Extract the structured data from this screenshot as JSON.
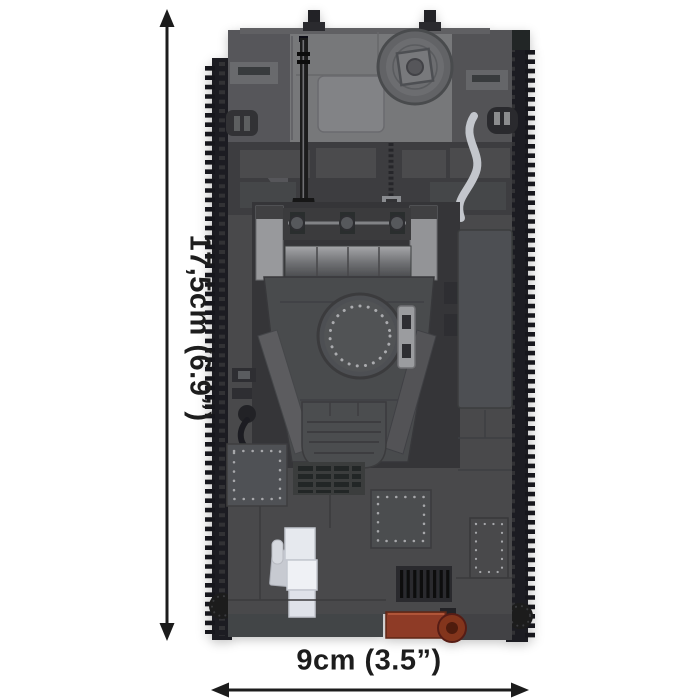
{
  "figure": {
    "type": "product-dimension-image",
    "subject": "building-block tank model, top view",
    "height_label": "17,5cm (6.9”)",
    "width_label": "9cm (3.5”)"
  },
  "colors": {
    "background": "#ffffff",
    "dimension_lines": "#1c1c1c",
    "label_text": "#1d1d1d",
    "track_dark": "#1e1f21",
    "hull_gray": "#48494b",
    "deck_light_gray": "#77787a",
    "panel_dark_gray": "#3b3c3e",
    "turret_gray": "#4a4b4e",
    "metal_light_gray": "#98999c",
    "white_brick": "#e6e9ee",
    "red_brick": "#8e3b26",
    "silver_pipe": "#c3c6cc"
  },
  "parts": [
    "left-track",
    "right-track",
    "hull-deck",
    "fuel-hatch",
    "gun-barrel",
    "antenna",
    "exhaust-pipe",
    "turret",
    "turret-hatch",
    "hatch-handle",
    "storage-panel",
    "rivet-panel-left",
    "rivet-panel-center",
    "rivet-panel-right",
    "louver-vent",
    "engine-grille",
    "white-bricks",
    "red-tow-brick",
    "tow-hook"
  ]
}
